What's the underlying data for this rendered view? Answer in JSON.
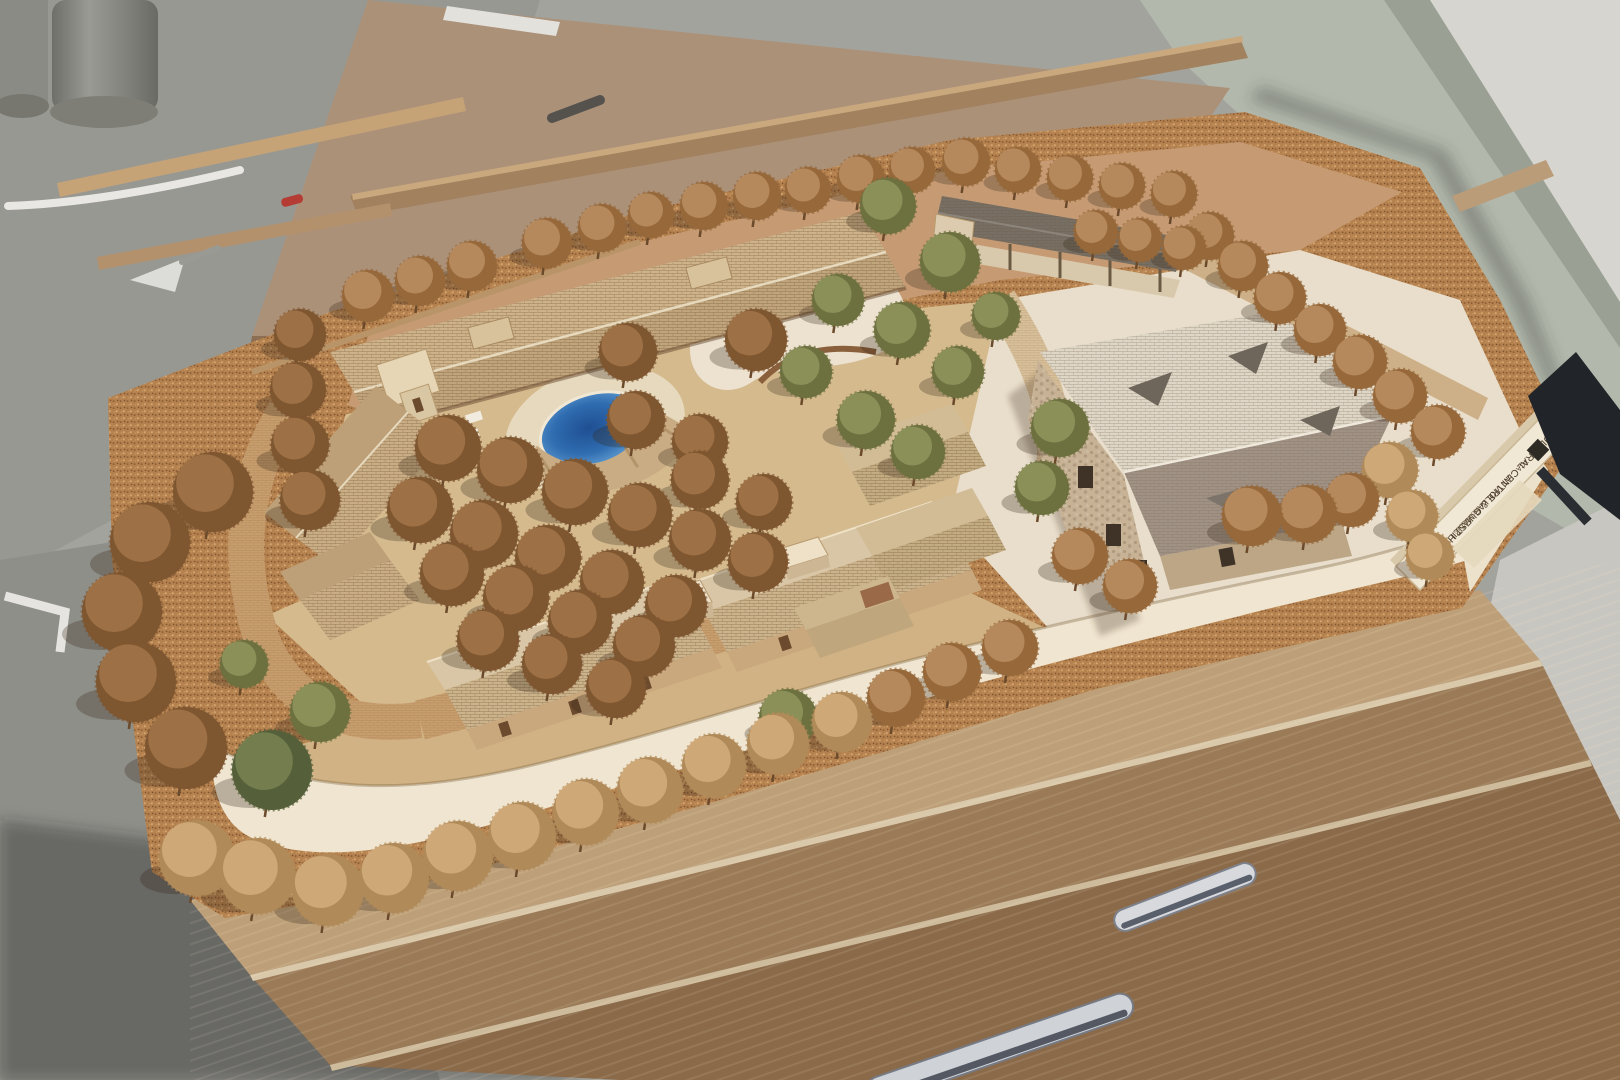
{
  "meta": {
    "title": "Photograph of an architectural scale model on a workshop rooftop",
    "subject": "site model with courtyard buildings, pool, guest house and tree field"
  },
  "scene": {
    "plaque": {
      "line1": "CULTURAL CENTRE & GUEST HOUSE",
      "line2": "AT VIOLLAR MANZIL",
      "line3": "ARCHITECTS",
      "logo": "TCA"
    },
    "palette": {
      "floor_concrete": "#a3a39d",
      "floor_green": "#b2b8ab",
      "wall_white": "#d6d5cf",
      "plywood": "#ac9179",
      "cork_base": "#b5824f",
      "terrain_cream": "#efe5d0",
      "ground_tan": "#d5ba8e",
      "ground_pink": "#c69b74",
      "plaza_light": "#e8decb",
      "roof_shingle": "#cdb28a",
      "roof_big_house": "#ded6c6",
      "roof_pavilion": "#776f63",
      "pool_water": "#2f6cb0",
      "cabinet_wood": "#9a7a57",
      "handle_metal": "#d7d9dc"
    },
    "tree_colors": {
      "b": {
        "dark": "#7e5630",
        "light": "#a87a4c"
      },
      "r": {
        "dark": "#96683a",
        "light": "#c09468"
      },
      "t": {
        "dark": "#b08a58",
        "light": "#d9b183"
      },
      "g": {
        "dark": "#6d713f",
        "light": "#969962"
      },
      "d": {
        "dark": "#55603a",
        "light": "#7d8756"
      }
    },
    "trees": [
      [
        368,
        296,
        26,
        "r"
      ],
      [
        420,
        281,
        25,
        "r"
      ],
      [
        472,
        266,
        25,
        "r"
      ],
      [
        547,
        243,
        25,
        "r"
      ],
      [
        602,
        228,
        24,
        "r"
      ],
      [
        651,
        215,
        23,
        "r"
      ],
      [
        704,
        206,
        24,
        "r"
      ],
      [
        757,
        196,
        24,
        "r"
      ],
      [
        808,
        190,
        23,
        "r"
      ],
      [
        861,
        179,
        24,
        "r"
      ],
      [
        912,
        170,
        23,
        "r"
      ],
      [
        966,
        162,
        24,
        "r"
      ],
      [
        1018,
        170,
        23,
        "r"
      ],
      [
        1070,
        178,
        23,
        "r"
      ],
      [
        1122,
        186,
        23,
        "r"
      ],
      [
        1174,
        194,
        23,
        "r"
      ],
      [
        1210,
        236,
        24,
        "r"
      ],
      [
        1243,
        266,
        25,
        "r"
      ],
      [
        1280,
        298,
        26,
        "r"
      ],
      [
        1320,
        330,
        26,
        "r"
      ],
      [
        1360,
        362,
        27,
        "r"
      ],
      [
        1400,
        396,
        27,
        "r"
      ],
      [
        1438,
        432,
        27,
        "r"
      ],
      [
        1390,
        470,
        28,
        "t"
      ],
      [
        1412,
        516,
        26,
        "t"
      ],
      [
        1430,
        556,
        24,
        "t"
      ],
      [
        1252,
        516,
        30,
        "r"
      ],
      [
        1308,
        514,
        29,
        "r"
      ],
      [
        1352,
        500,
        27,
        "r"
      ],
      [
        1080,
        556,
        28,
        "r"
      ],
      [
        1130,
        586,
        27,
        "r"
      ],
      [
        1060,
        428,
        29,
        "g"
      ],
      [
        1042,
        488,
        27,
        "g"
      ],
      [
        888,
        206,
        28,
        "g"
      ],
      [
        950,
        262,
        30,
        "g"
      ],
      [
        902,
        330,
        28,
        "g"
      ],
      [
        838,
        300,
        26,
        "g"
      ],
      [
        958,
        372,
        26,
        "g"
      ],
      [
        866,
        420,
        29,
        "g"
      ],
      [
        806,
        372,
        26,
        "g"
      ],
      [
        918,
        452,
        27,
        "g"
      ],
      [
        996,
        316,
        24,
        "g"
      ],
      [
        448,
        448,
        33,
        "b"
      ],
      [
        510,
        470,
        33,
        "b"
      ],
      [
        575,
        492,
        33,
        "b"
      ],
      [
        640,
        515,
        32,
        "b"
      ],
      [
        700,
        540,
        31,
        "b"
      ],
      [
        758,
        562,
        30,
        "b"
      ],
      [
        420,
        510,
        33,
        "b"
      ],
      [
        484,
        534,
        34,
        "b"
      ],
      [
        548,
        558,
        33,
        "b"
      ],
      [
        612,
        582,
        32,
        "b"
      ],
      [
        676,
        606,
        31,
        "b"
      ],
      [
        452,
        574,
        32,
        "b"
      ],
      [
        516,
        598,
        33,
        "b"
      ],
      [
        580,
        622,
        32,
        "b"
      ],
      [
        644,
        646,
        31,
        "b"
      ],
      [
        488,
        640,
        31,
        "b"
      ],
      [
        552,
        664,
        30,
        "b"
      ],
      [
        616,
        688,
        30,
        "b"
      ],
      [
        700,
        480,
        29,
        "b"
      ],
      [
        764,
        502,
        28,
        "b"
      ],
      [
        636,
        420,
        29,
        "b"
      ],
      [
        700,
        442,
        28,
        "b"
      ],
      [
        628,
        352,
        29,
        "b"
      ],
      [
        756,
        340,
        31,
        "b"
      ],
      [
        300,
        335,
        26,
        "b"
      ],
      [
        298,
        390,
        28,
        "b"
      ],
      [
        300,
        445,
        29,
        "b"
      ],
      [
        310,
        500,
        30,
        "b"
      ],
      [
        213,
        492,
        40,
        "b"
      ],
      [
        150,
        542,
        40,
        "b"
      ],
      [
        122,
        612,
        40,
        "b"
      ],
      [
        136,
        682,
        40,
        "b"
      ],
      [
        186,
        748,
        41,
        "b"
      ],
      [
        272,
        770,
        40,
        "d"
      ],
      [
        320,
        712,
        30,
        "g"
      ],
      [
        244,
        664,
        24,
        "g"
      ],
      [
        197,
        858,
        38,
        "t"
      ],
      [
        258,
        876,
        38,
        "t"
      ],
      [
        328,
        890,
        36,
        "t"
      ],
      [
        394,
        878,
        35,
        "t"
      ],
      [
        458,
        856,
        35,
        "t"
      ],
      [
        522,
        836,
        34,
        "t"
      ],
      [
        586,
        812,
        33,
        "t"
      ],
      [
        650,
        790,
        33,
        "t"
      ],
      [
        714,
        766,
        32,
        "t"
      ],
      [
        778,
        744,
        31,
        "t"
      ],
      [
        842,
        722,
        30,
        "t"
      ],
      [
        896,
        698,
        29,
        "r"
      ],
      [
        952,
        672,
        29,
        "r"
      ],
      [
        1010,
        648,
        28,
        "r"
      ],
      [
        788,
        718,
        29,
        "g"
      ],
      [
        1096,
        232,
        22,
        "r"
      ],
      [
        1140,
        240,
        22,
        "r"
      ],
      [
        1184,
        248,
        22,
        "r"
      ]
    ]
  }
}
